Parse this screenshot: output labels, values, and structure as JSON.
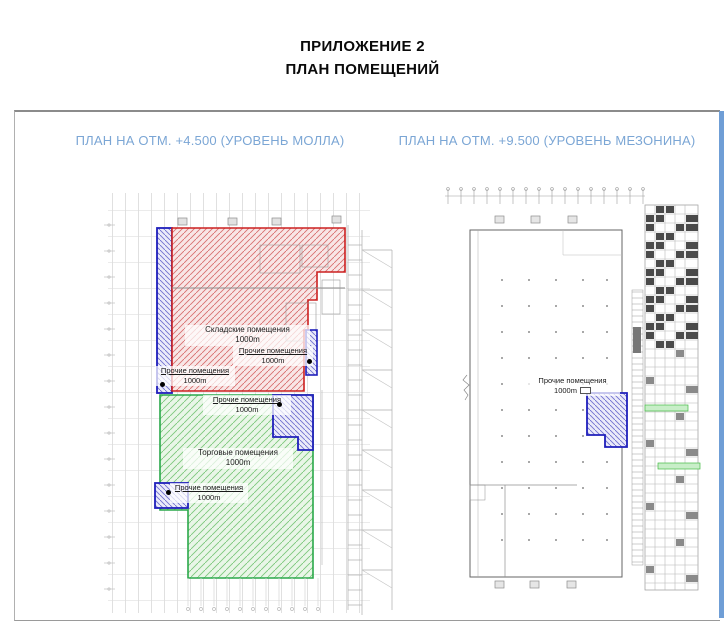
{
  "document": {
    "title_line1": "ПРИЛОЖЕНИЕ 2",
    "title_line2": "ПЛАН ПОМЕЩЕНИЙ"
  },
  "plans": {
    "mall": {
      "title": "ПЛАН НА ОТМ. +4.500 (УРОВЕНЬ МОЛЛА)",
      "labels": {
        "warehouse": {
          "name": "Складские помещения",
          "area": "1000m"
        },
        "other_mid_right": {
          "name": "Прочие помещения",
          "area": "1000m"
        },
        "other_left": {
          "name": "Прочие помещения",
          "area": "1000m"
        },
        "other_green_top": {
          "name": "Прочие помещения",
          "area": "1000m"
        },
        "retail": {
          "name": "Торговые помещения",
          "area": "1000m"
        },
        "other_bottom_left": {
          "name": "Прочие помещения",
          "area": "1000m"
        }
      }
    },
    "mezzanine": {
      "title": "ПЛАН НА ОТМ. +9.500 (УРОВЕНЬ МЕЗОНИНА)",
      "labels": {
        "other": {
          "name": "Прочие помещения",
          "area": "1000m"
        }
      }
    }
  },
  "colors": {
    "warehouse_zone": "#cc2020",
    "retail_zone": "#2aa84a",
    "other_zone": "#1f1fbb",
    "plan_title_text": "#7ba6d5",
    "frame_right_bar": "#6f9ed6"
  }
}
